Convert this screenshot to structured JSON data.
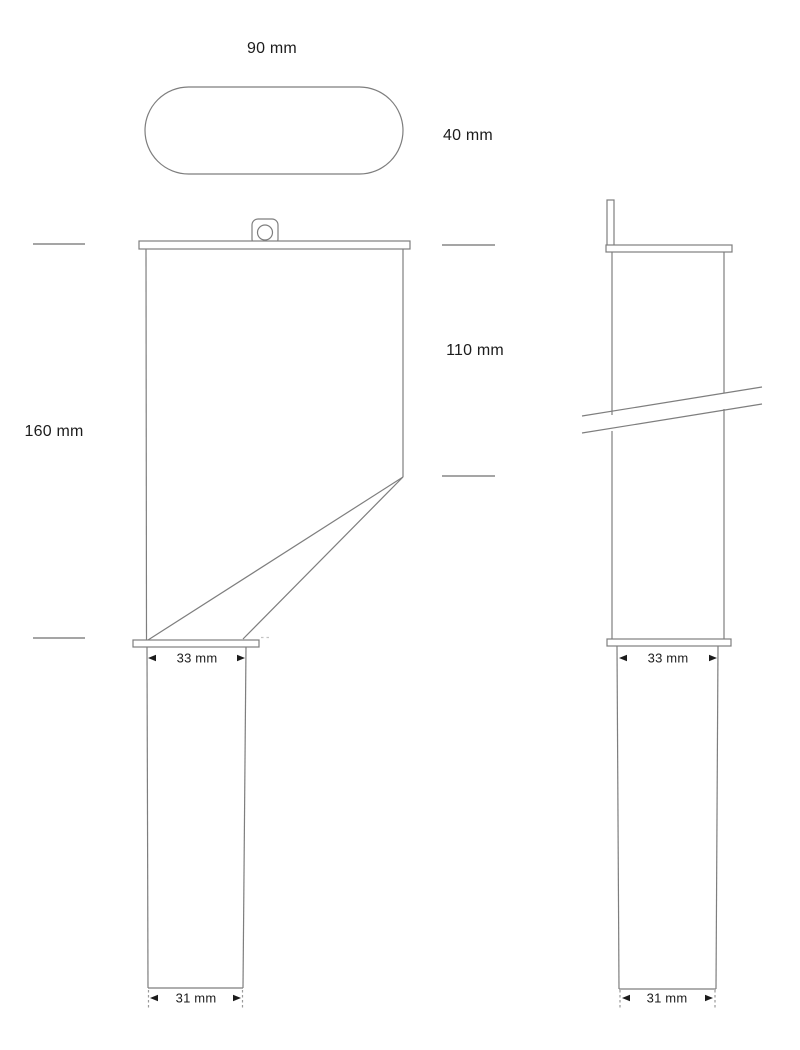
{
  "drawing": {
    "type": "technical-drawing",
    "views": [
      "top-view",
      "front-view",
      "side-view"
    ],
    "colors": {
      "line": "#7e7e7e",
      "text": "#1c1c1c",
      "background": "#ffffff"
    }
  },
  "dims": {
    "top_width": "90 mm",
    "top_depth": "40 mm",
    "front_height": "160 mm",
    "front_upper": "110 mm",
    "front_outlet_top": "33 mm",
    "front_outlet_bottom": "31 mm",
    "side_outlet_top": "33 mm",
    "side_outlet_bottom": "31 mm"
  }
}
